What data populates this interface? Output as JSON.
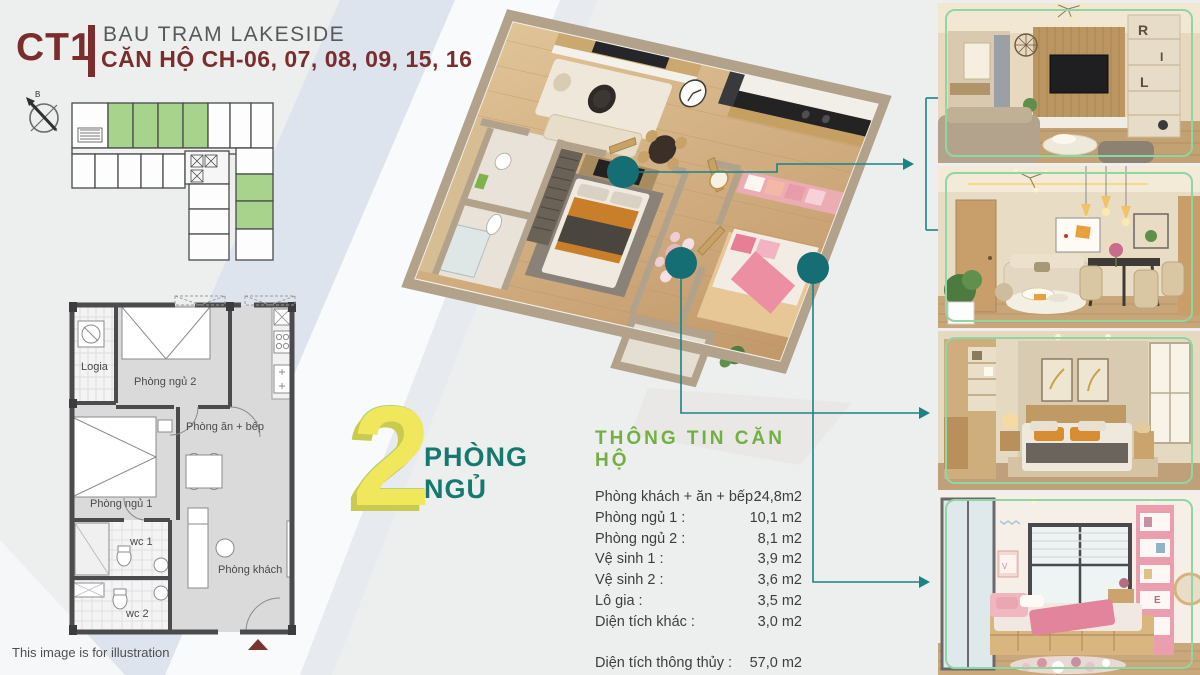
{
  "header": {
    "block": "CT1",
    "project": "BAU TRAM LAKESIDE",
    "units": "CĂN HỘ CH-06, 07, 08, 09, 15, 16"
  },
  "compass": {
    "north_label": "B"
  },
  "floor_plate": {
    "highlighted_units_top_row": 4,
    "highlighted_units_right_wing": 2,
    "highlight_color": "#a7d38d"
  },
  "plan2d": {
    "labels": {
      "logia": "Logia",
      "bedroom2": "Phòng ngủ 2",
      "kitchen": "Phòng ăn + bếp",
      "bedroom1": "Phòng ngủ 1",
      "wc1": "wc 1",
      "wc2": "wc 2",
      "living": "Phòng khách"
    }
  },
  "badge": {
    "number": "2",
    "line1": "PHÒNG",
    "line2": "NGỦ"
  },
  "info": {
    "title": "THÔNG TIN CĂN HỘ",
    "rows": [
      {
        "label": "Phòng khách + ăn + bếp :",
        "value": "24,8m2"
      },
      {
        "label": "Phòng ngủ 1 :",
        "value": "10,1 m2"
      },
      {
        "label": "Phòng ngủ 2 :",
        "value": "8,1 m2"
      },
      {
        "label": "Vệ sinh 1 :",
        "value": "3,9 m2"
      },
      {
        "label": "Vệ sinh 2 :",
        "value": "3,6 m2"
      },
      {
        "label": "Lô gia :",
        "value": "3,5 m2"
      },
      {
        "label": "Diện tích khác :",
        "value": "3,0 m2"
      }
    ],
    "totals": [
      {
        "label": "Diện tích thông thủy :",
        "value": "57,0 m2"
      },
      {
        "label": "Diện tích tim tường :",
        "value": "61,8 m2"
      }
    ]
  },
  "footnote": "This image is for illustration",
  "colors": {
    "maroon": "#7b2d2e",
    "teal_line": "#1d8285",
    "teal_dot": "#146e74",
    "green_title": "#72b043",
    "green_frame": "#90d6a2",
    "yellow_number": "#f1e75c",
    "teal_text": "#14796f"
  }
}
